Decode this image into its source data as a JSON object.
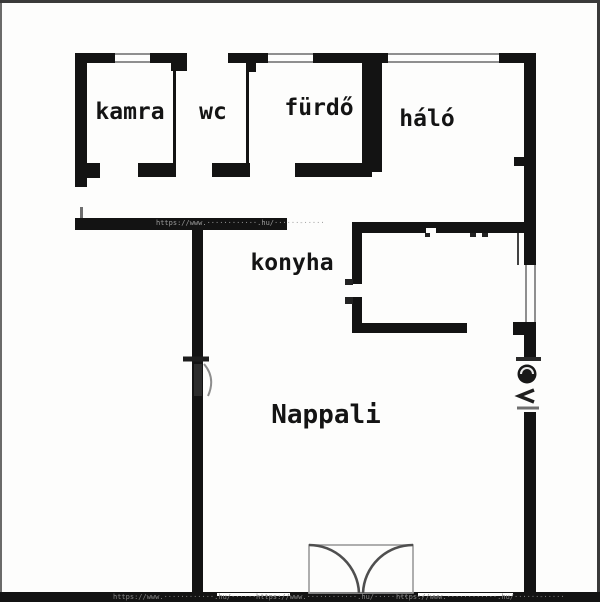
{
  "diagram": {
    "type": "floor-plan",
    "language": "Hungarian"
  },
  "rooms": [
    {
      "id": "kamra",
      "label": "kamra"
    },
    {
      "id": "wc",
      "label": "wc"
    },
    {
      "id": "furdo",
      "label": "fürdő"
    },
    {
      "id": "halo",
      "label": "háló"
    },
    {
      "id": "konyha",
      "label": "konyha"
    },
    {
      "id": "nappali",
      "label": "Nappali"
    }
  ],
  "colors": {
    "wall": "#131313",
    "background": "#fdfdfc",
    "window_line": "#8f8f8f",
    "door_outline": "#9b9b9b",
    "door_arc": "#4f4f4f",
    "watermark_on_wall": "#9a9a9a",
    "watermark_on_band": "#858585",
    "border": "#3a3a3a"
  },
  "watermark": {
    "wall_text": "https://www.············.hu/······-·····",
    "band_text_left": "https://www.············.hu/······-·····",
    "band_text_mid": "https://www.············.hu/······-·····",
    "band_text_right": "https://www.············.hu/······-·····"
  }
}
